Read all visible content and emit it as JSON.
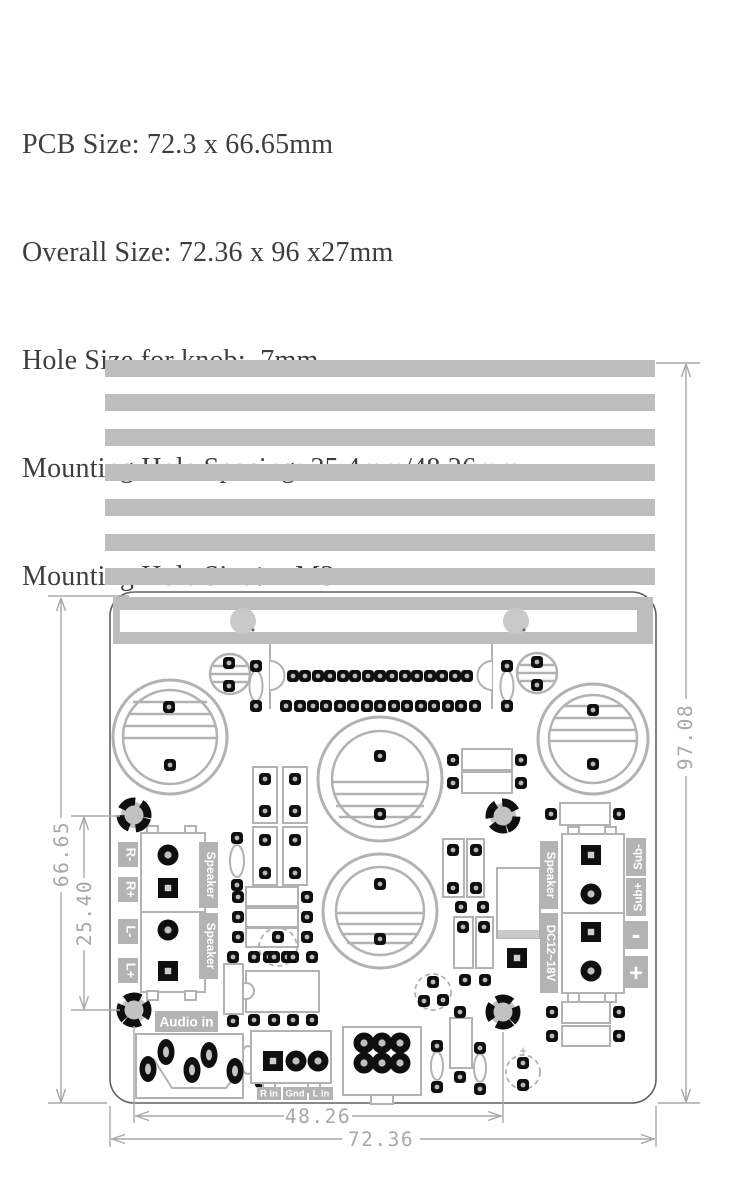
{
  "specs": {
    "pcb_size": "PCB Size: 72.3 x 66.65mm",
    "overall_size": "Overall Size: 72.36 x 96 x27mm",
    "knob_hole": "Hole Size for knob:  7mm",
    "mount_spacing": "Mounting Hole Spacing: 25.4mm/48.26mm",
    "mount_size": "Mounting Hole Size：  M3"
  },
  "dims": {
    "pcb_height": "66.65",
    "mount_spacing_v": "25.40",
    "overall_height": "97.08",
    "mount_spacing_h": "48.26",
    "pcb_width": "72.36"
  },
  "labels": {
    "audio_in": "Audio in",
    "speaker_left_top": "Speaker",
    "speaker_left_bottom": "Speaker",
    "r_minus": "R-",
    "r_plus": "R+",
    "l_minus": "L-",
    "l_plus": "L+",
    "speaker_right": "Speaker",
    "dc_power": "DC12~18V",
    "sub_minus": "Sub-",
    "sub_plus": "Sub+",
    "minus": "-",
    "plus": "+",
    "r_in": "R in",
    "gnd": "Gnd",
    "l_in": "L in",
    "polarity_plus": "+"
  },
  "colors": {
    "heatsink_gray": "#bdbdbd",
    "label_gray": "#b3b3b3",
    "dimension_gray": "#a8a8a8",
    "pad_black": "#0f0f0f"
  }
}
